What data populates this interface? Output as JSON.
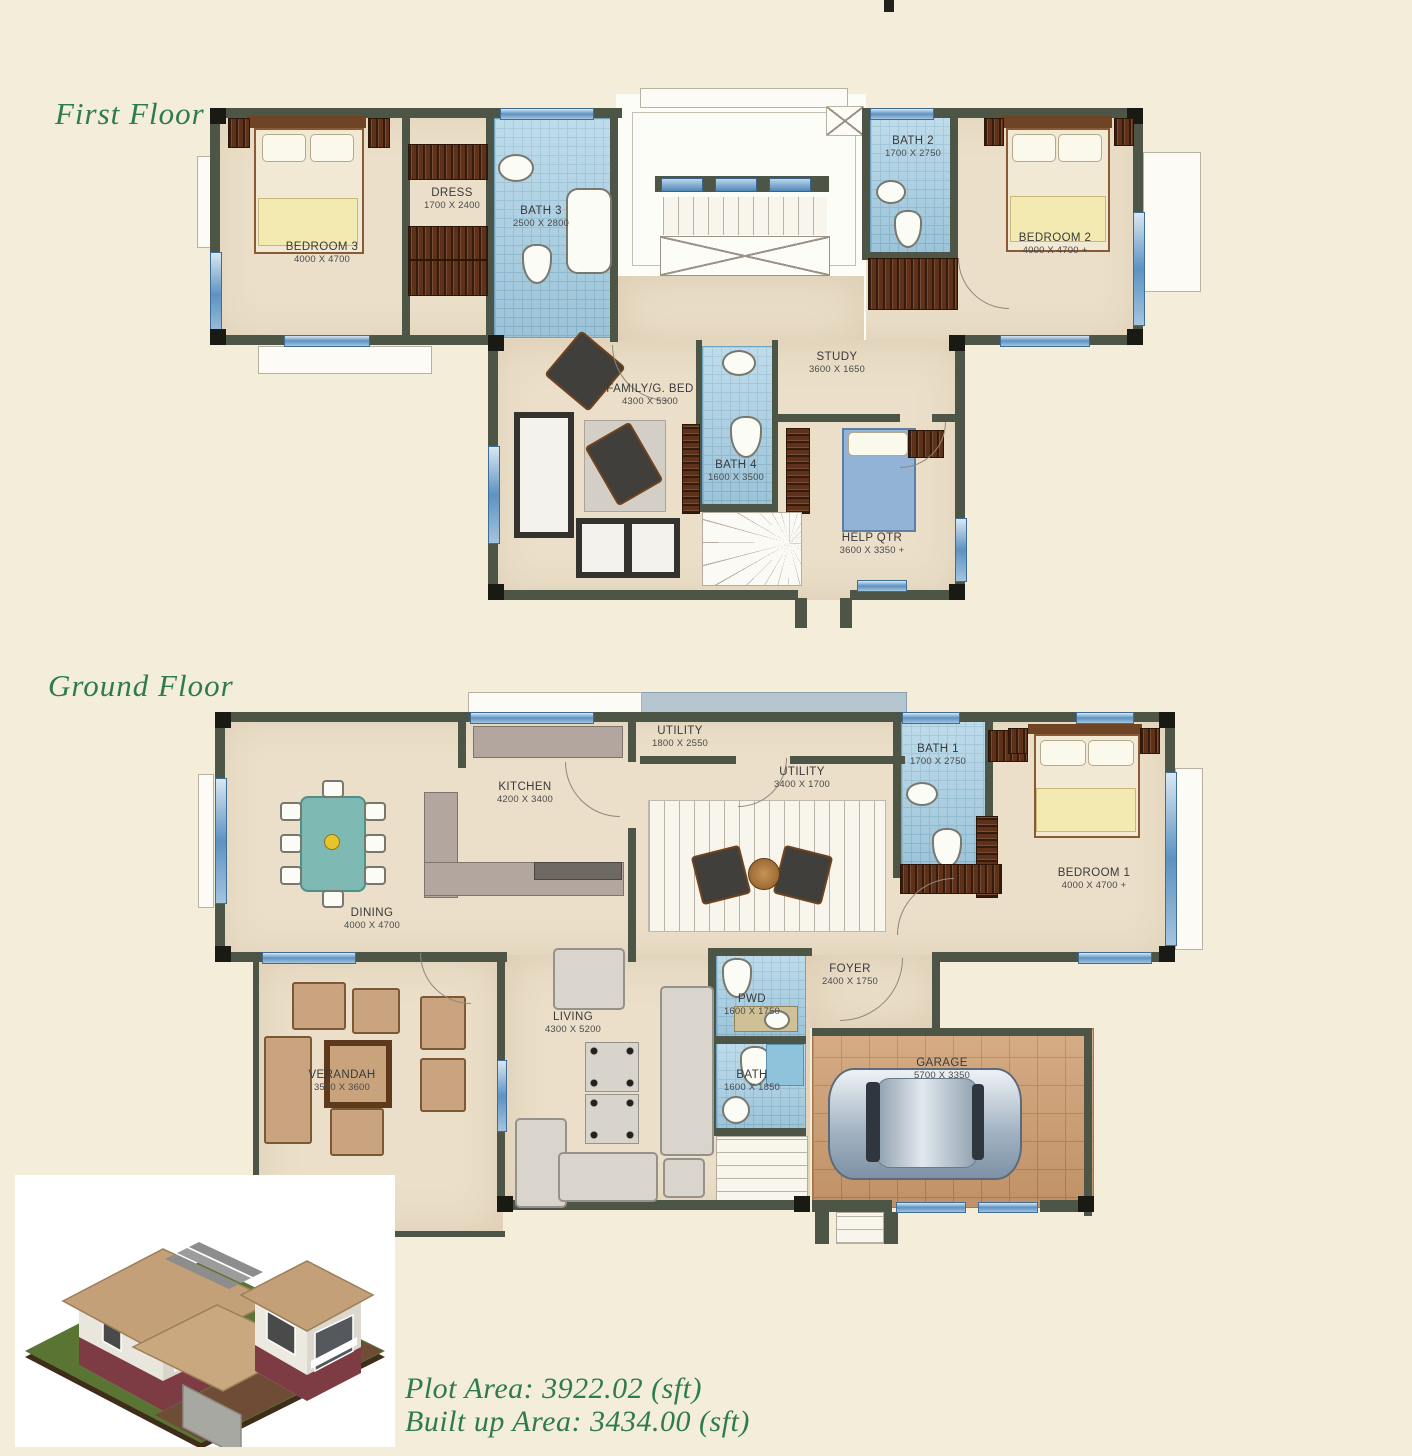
{
  "sheet": {
    "first_floor_title": "First Floor",
    "ground_floor_title": "Ground Floor",
    "plot_area_line": "Plot Area: 3922.02  (sft)",
    "built_up_area_line": "Built up Area: 3434.00 (sft)"
  },
  "colors": {
    "page_background": "#f3edd9",
    "plan_floor": "#ebdfc9",
    "wall": "#4d5546",
    "bath_tile": "#a9d0e4",
    "window_blue": "#5d92c2",
    "title_green": "#2e7b4e",
    "wood": "#5e3118",
    "garage_floor": "#cf9f72"
  },
  "floors": {
    "first": {
      "rooms": {
        "bedroom3": {
          "name": "BEDROOM 3",
          "dims": "4000 X 4700"
        },
        "dress": {
          "name": "DRESS",
          "dims": "1700 X 2400"
        },
        "bath3": {
          "name": "BATH 3",
          "dims": "2500 X 2800"
        },
        "bath2": {
          "name": "BATH 2",
          "dims": "1700 X 2750"
        },
        "bedroom2": {
          "name": "BEDROOM 2",
          "dims": "4000 X 4700 +"
        },
        "family": {
          "name": "FAMILY/G. BED",
          "dims": "4300 X 5300"
        },
        "study": {
          "name": "STUDY",
          "dims": "3600 X 1650"
        },
        "bath4": {
          "name": "BATH 4",
          "dims": "1600 X 3500"
        },
        "helpqtr": {
          "name": "HELP QTR",
          "dims": "3600 X 3350 +"
        }
      }
    },
    "ground": {
      "rooms": {
        "kitchen": {
          "name": "KITCHEN",
          "dims": "4200 X 3400"
        },
        "utility_small": {
          "name": "UTILITY",
          "dims": "1800 X 2550"
        },
        "utility": {
          "name": "UTILITY",
          "dims": "3400 X 1700"
        },
        "bath1": {
          "name": "BATH 1",
          "dims": "1700 X 2750"
        },
        "bedroom1": {
          "name": "BEDROOM 1",
          "dims": "4000 X 4700 +"
        },
        "dining": {
          "name": "DINING",
          "dims": "4000 X 4700"
        },
        "verandah": {
          "name": "VERANDAH",
          "dims": "3550 X 3600"
        },
        "living": {
          "name": "LIVING",
          "dims": "4300 X 5200"
        },
        "pwd": {
          "name": "PWD",
          "dims": "1600 X 1750"
        },
        "bath": {
          "name": "BATH",
          "dims": "1600 X 1850"
        },
        "foyer": {
          "name": "FOYER",
          "dims": "2400 X 1750"
        },
        "garage": {
          "name": "GARAGE",
          "dims": "5700 X 3350"
        }
      }
    }
  }
}
